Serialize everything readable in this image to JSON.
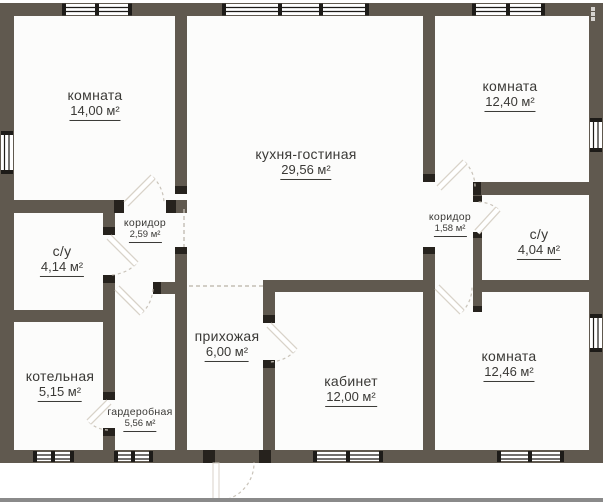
{
  "title": "floor-plan",
  "colors": {
    "wall": "#60594f",
    "floor": "#fcfcfb",
    "text": "#3a3936",
    "jamb": "#26221d",
    "window_frame": "#1d1b18",
    "dashed_line": "#c4beb4",
    "bottom_bar": "#8a8a8a"
  },
  "icons": {
    "more_options": "kebab-menu"
  },
  "rooms": [
    {
      "id": "room-1",
      "name": "комната",
      "area": "14,00 м²"
    },
    {
      "id": "kitchen-living",
      "name": "кухня-гостиная",
      "area": "29,56 м²"
    },
    {
      "id": "room-2",
      "name": "комната",
      "area": "12,40 м²"
    },
    {
      "id": "corridor-left",
      "name": "коридор",
      "area": "2,59 м²"
    },
    {
      "id": "bathroom-left",
      "name": "с/у",
      "area": "4,14 м²"
    },
    {
      "id": "corridor-right",
      "name": "коридор",
      "area": "1,58 м²"
    },
    {
      "id": "bathroom-right",
      "name": "с/у",
      "area": "4,04 м²"
    },
    {
      "id": "boiler-room",
      "name": "котельная",
      "area": "5,15 м²"
    },
    {
      "id": "wardrobe",
      "name": "гардеробная",
      "area": "5,56 м²"
    },
    {
      "id": "hallway",
      "name": "прихожая",
      "area": "6,00 м²"
    },
    {
      "id": "office",
      "name": "кабинет",
      "area": "12,00 м²"
    },
    {
      "id": "room-3",
      "name": "комната",
      "area": "12,46 м²"
    }
  ]
}
